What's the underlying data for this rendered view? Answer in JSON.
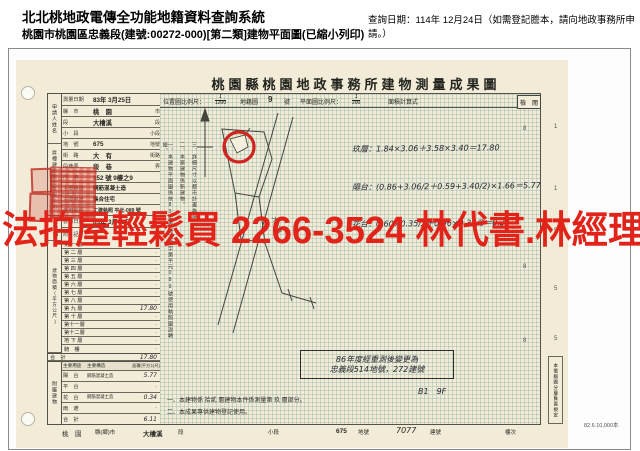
{
  "header": {
    "system_title": "北北桃地政電傳全功能地籍資料查詢系統",
    "subtitle": "桃園市桃園區忠義段(建號:00272-000)[第二類]建物平面圖(已縮小列印)",
    "query_date": "查詢日期：114年 12月24日（如需登記謄本，請向地政事務所申請。）"
  },
  "watermark": {
    "text": "法拍屋輕鬆買 2266-3524 林代書.林經理",
    "color": "#e2231a",
    "style": "color:#e2231a"
  },
  "doc": {
    "title": "桃園縣桃園地政事務所建物測量成果圖",
    "applicant_label": "申請人姓名",
    "applicant_company": "昇樺建設股份有限公司",
    "applicant_name": "吳玲娟",
    "fields": [
      {
        "label": "測量日期",
        "value": "83年 3月25日",
        "suffix": ""
      },
      {
        "label": "縣　市",
        "value": "桃　園",
        "suffix": "市"
      },
      {
        "label": "段",
        "value": "大檜溪",
        "suffix": "段"
      },
      {
        "label": "小　段",
        "value": "",
        "suffix": "小段"
      },
      {
        "label": "地　號",
        "value": "675",
        "suffix": "地號"
      },
      {
        "label": "街　路",
        "value": "大　有",
        "suffix": "街路"
      },
      {
        "label": "段巷弄",
        "value": "段　巷",
        "suffix": "弄"
      },
      {
        "label": "門　牌",
        "value": "152 號 9樓之9",
        "suffix": ""
      },
      {
        "label": "主要構造",
        "value": "鋼筋混凝土造",
        "suffix": ""
      },
      {
        "label": "主要用途",
        "value": "集合住宅",
        "suffix": ""
      },
      {
        "label": "使用執照",
        "value": "工建執照 平元-089 號",
        "suffix": ""
      },
      {
        "label": "發照日期",
        "value": "83年 3月18日",
        "suffix": ""
      },
      {
        "label": "附　記",
        "value": "·",
        "suffix": ""
      }
    ],
    "floor_section_label": "建物面積(平方公尺)",
    "floors": [
      {
        "label": "第 一 層",
        "value": "·"
      },
      {
        "label": "第 二 層",
        "value": "·"
      },
      {
        "label": "第 三 層",
        "value": "·"
      },
      {
        "label": "第 四 層",
        "value": "·"
      },
      {
        "label": "第 五 層",
        "value": "·"
      },
      {
        "label": "第 六 層",
        "value": "·"
      },
      {
        "label": "第 七 層",
        "value": "·"
      },
      {
        "label": "第 八 層",
        "value": "·"
      },
      {
        "label": "第 九 層",
        "value": "17.80"
      },
      {
        "label": "第 十 層",
        "value": "·"
      },
      {
        "label": "第十一層",
        "value": "·"
      },
      {
        "label": "第十二層",
        "value": "·"
      },
      {
        "label": "地 下 層",
        "value": "·"
      },
      {
        "label": "騎　樓",
        "value": "·"
      }
    ],
    "floor_total": {
      "label": "合　計",
      "value": "17.80"
    },
    "attached": {
      "section_label": "附屬建物",
      "headers": [
        "主要用途",
        "主要構造",
        "面積(平方公尺)"
      ],
      "rows": [
        {
          "use": "陽　台",
          "structure": "鋼筋混凝土造",
          "area": "5.77"
        },
        {
          "use": "平　台",
          "structure": "",
          "area": "·"
        },
        {
          "use": "花　台",
          "structure": "鋼筋混凝土造",
          "area": "0.34"
        },
        {
          "use": "雨　遮",
          "structure": "",
          "area": "·"
        },
        {
          "use": "合　計",
          "structure": "",
          "area": "6.11"
        }
      ]
    },
    "scale": {
      "loc_label": "位置圖比例尺：",
      "loc_num": "1",
      "loc_den": "1200",
      "sheet": "地籍圖",
      "sheet_no": "9",
      "sheet_unit": "號",
      "plan_label": "平面圖比例尺：",
      "plan_num": "1",
      "plan_den": "200",
      "calc_label": "面積計算式",
      "check_label": "檢　閱"
    },
    "map_notes": [
      "一、本建物平面圖係依83年桃縣工建字第平元089號使用執照圖說轉繪。",
      "二、本案建物係新建物。",
      "三、詳細尺寸以都市計畫為準。"
    ],
    "street_label": "大有路",
    "calc_lines": [
      "玖層：1.84×3.06＋3.58×3.40＝17.80",
      "陽台：(0.86+3.06∕2＋0.59+3.40∕2)×1.66＝5.77",
      "花台：0.60×0.35∕2＋0.96×0.35∕2＝0.34"
    ],
    "remeasure_note": {
      "line1": "86年度經重測後變更為",
      "line2": "忠義段514地號，272建號"
    },
    "handwritten_mark": "B1　9F",
    "bottom_notes": [
      "一、本建物係 拾貳 層建物本件係測量第 玖 層部分。",
      "二、本成果專供建物登記使用。"
    ],
    "footer": {
      "county": "桃　園",
      "county_suffix": "縣(鄉)市",
      "section": "大檜溪",
      "section_suffix": "段",
      "small_section_suffix": "小段",
      "parcel": "675",
      "parcel_suffix": "地號",
      "building_no": "7077",
      "building_suffix": "建號",
      "floor_suffix": "樓次"
    },
    "print_info": "82.6.10,000本",
    "right_strip_note": "本電腦圖分層負責規定",
    "edge_numbers_right": [
      "1",
      "1",
      "5",
      "5",
      "5",
      "5"
    ],
    "edge_numbers_map": [
      "8",
      "8",
      "8"
    ]
  }
}
